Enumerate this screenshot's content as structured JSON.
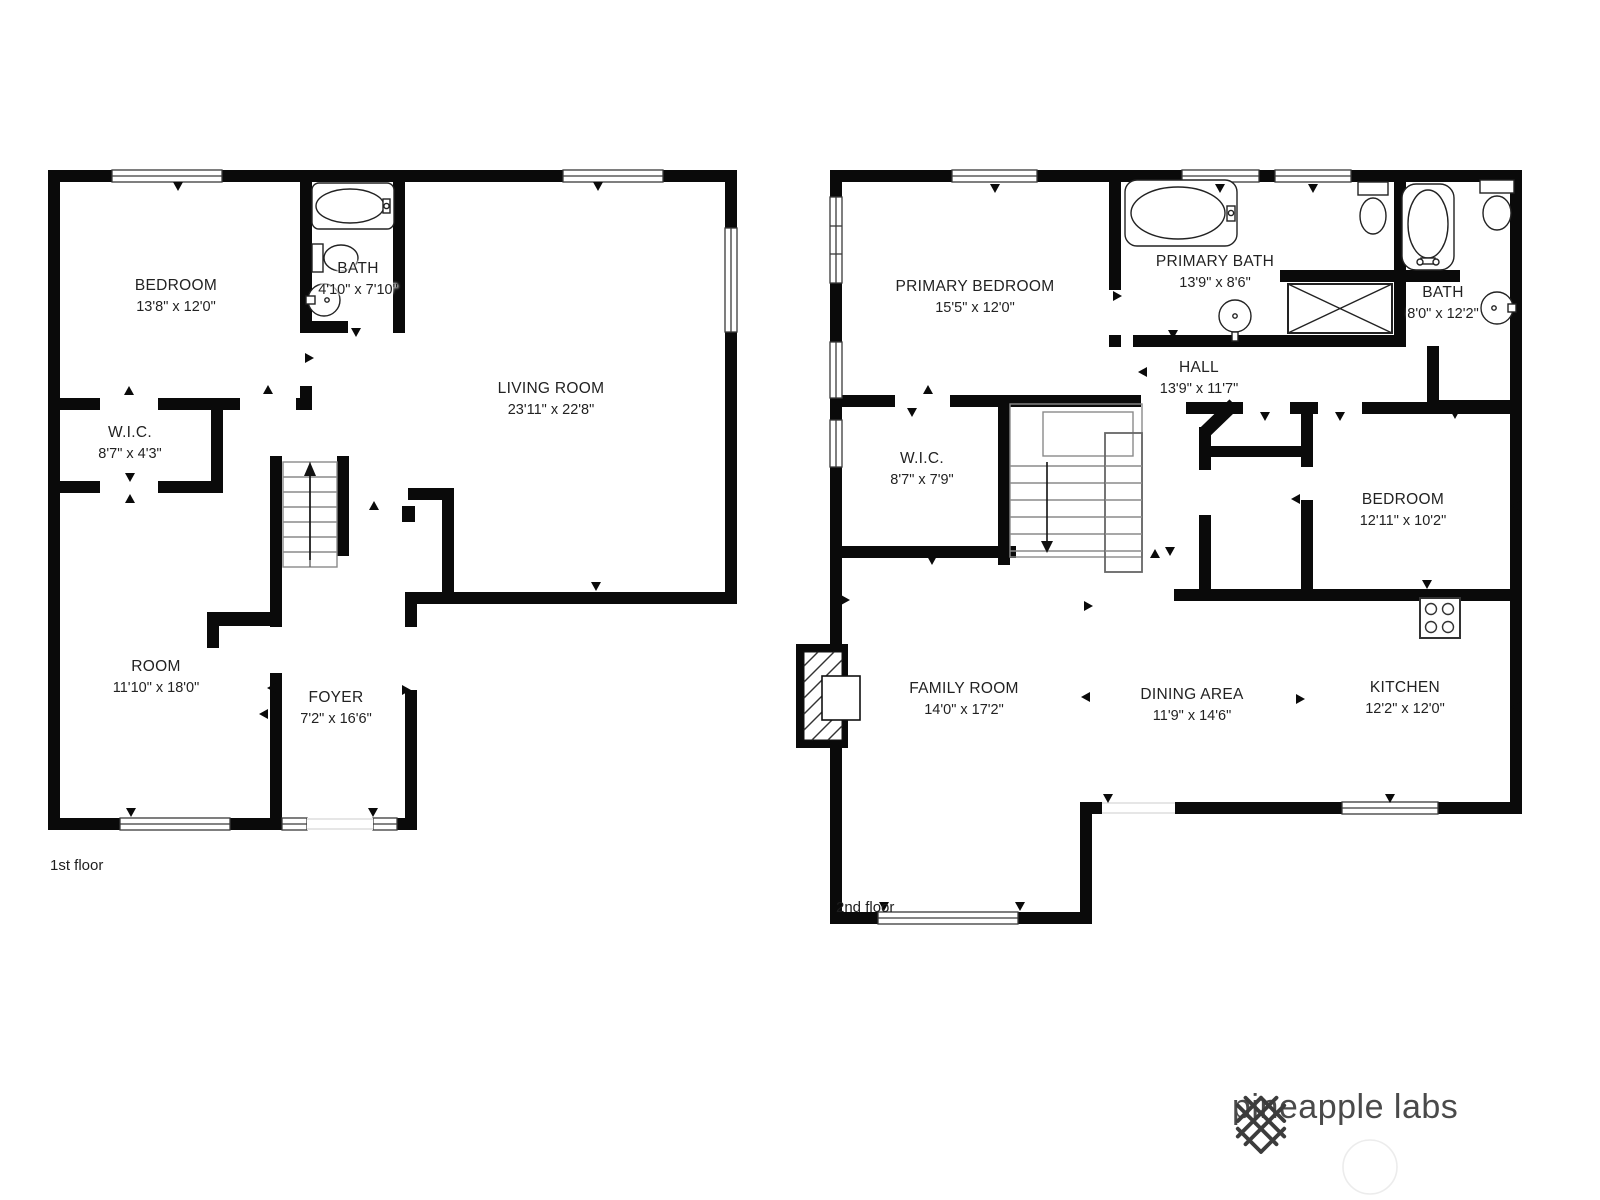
{
  "floors": {
    "first": {
      "label": "1st floor",
      "rooms": {
        "bedroom": {
          "name": "BEDROOM",
          "dims": "13'8\" x 12'0\""
        },
        "bath": {
          "name": "BATH",
          "dims": "4'10\" x 7'10\""
        },
        "living_room": {
          "name": "LIVING ROOM",
          "dims": "23'11\" x 22'8\""
        },
        "wic": {
          "name": "W.I.C.",
          "dims": "8'7\" x 4'3\""
        },
        "room": {
          "name": "ROOM",
          "dims": "11'10\" x 18'0\""
        },
        "foyer": {
          "name": "FOYER",
          "dims": "7'2\" x 16'6\""
        }
      }
    },
    "second": {
      "label": "2nd floor",
      "rooms": {
        "primary_bedroom": {
          "name": "PRIMARY BEDROOM",
          "dims": "15'5\" x 12'0\""
        },
        "primary_bath": {
          "name": "PRIMARY BATH",
          "dims": "13'9\" x 8'6\""
        },
        "bath": {
          "name": "BATH",
          "dims": "8'0\" x 12'2\""
        },
        "hall": {
          "name": "HALL",
          "dims": "13'9\" x 11'7\""
        },
        "wic": {
          "name": "W.I.C.",
          "dims": "8'7\" x 7'9\""
        },
        "bedroom": {
          "name": "BEDROOM",
          "dims": "12'11\" x 10'2\""
        },
        "family_room": {
          "name": "FAMILY ROOM",
          "dims": "14'0\" x 17'2\""
        },
        "dining_area": {
          "name": "DINING AREA",
          "dims": "11'9\" x 14'6\""
        },
        "kitchen": {
          "name": "KITCHEN",
          "dims": "12'2\" x 12'0\""
        }
      }
    }
  },
  "branding": {
    "logo_text": "pineapple labs"
  },
  "colors": {
    "wall": "#0a0a0a",
    "fixture_line": "#222222",
    "stair_line": "#8a8a8a"
  }
}
